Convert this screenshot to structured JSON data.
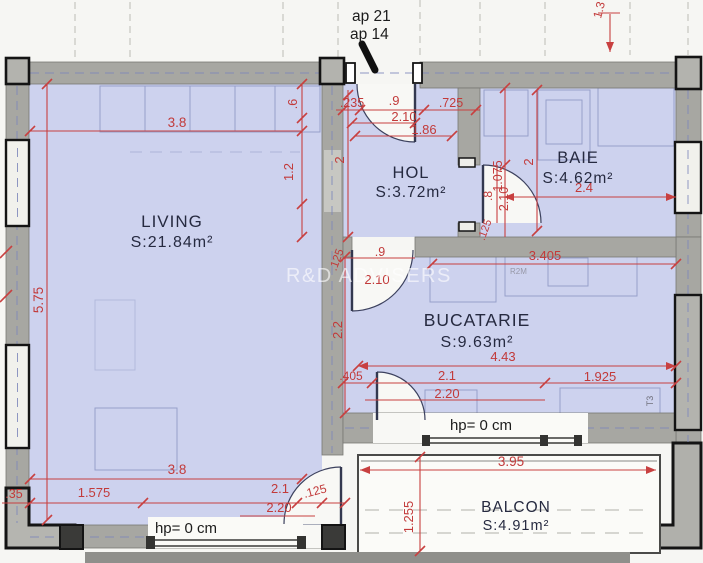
{
  "plan": {
    "unit_note_line1": "ap 21",
    "unit_note_line2": "ap 14",
    "watermark": "R&D ADVISERS",
    "door_code": "T3",
    "furniture_code": "R2M"
  },
  "rooms": {
    "living": {
      "name": "LIVING",
      "area": "S:21.84m²"
    },
    "hol": {
      "name": "HOL",
      "area": "S:3.72m²"
    },
    "baie": {
      "name": "BAIE",
      "area": "S:4.62m²"
    },
    "bucatarie": {
      "name": "BUCATARIE",
      "area": "S:9.63m²"
    },
    "balcon": {
      "name": "BALCON",
      "area": "S:4.91m²"
    }
  },
  "annotations": {
    "parapet_living": "hp= 0 cm",
    "parapet_kitchen": "hp= 0 cm"
  },
  "dims": {
    "entry_a": ".235",
    "entry_b": ".9",
    "entry_c": ".725",
    "entry_door_h": "2.10",
    "entry_clear": "1.86",
    "living_top": "3.8",
    "living_bottom": "3.8",
    "living_right_a": ".6",
    "living_right_b": "1.2",
    "living_left": "5.75",
    "hol_left": "2",
    "hol_door_off": ".125",
    "hol_door_w": ".9",
    "hol_door_h": "2.10",
    "baie_entry": "1.075",
    "baie_left": "2",
    "baie_width": "2.4",
    "baie_door_w": ".8",
    "baie_door_h": "2.10",
    "baie_door_off": ".125",
    "axis_right": "1.3",
    "kitchen_top": "3.405",
    "kitchen_left": "2.2",
    "kitchen_width": "4.43",
    "kitchen_door_off": ".405",
    "kitchen_open_w": "2.1",
    "kitchen_open_w2": "2.20",
    "kitchen_right": "1.925",
    "bottom_off": ".35",
    "bottom_a": "1.575",
    "bottom_win": "2.1",
    "bottom_win2": "2.20",
    "bottom_door_off": ".125",
    "balcony_w": "3.95",
    "balcony_d": "1.255"
  },
  "colors": {
    "dimension_red": "#c23a3a",
    "room_fill": "#cdd2ee",
    "wall_grey": "#a7a7a2",
    "label_navy": "#262a40",
    "background": "#f6f6f3"
  }
}
